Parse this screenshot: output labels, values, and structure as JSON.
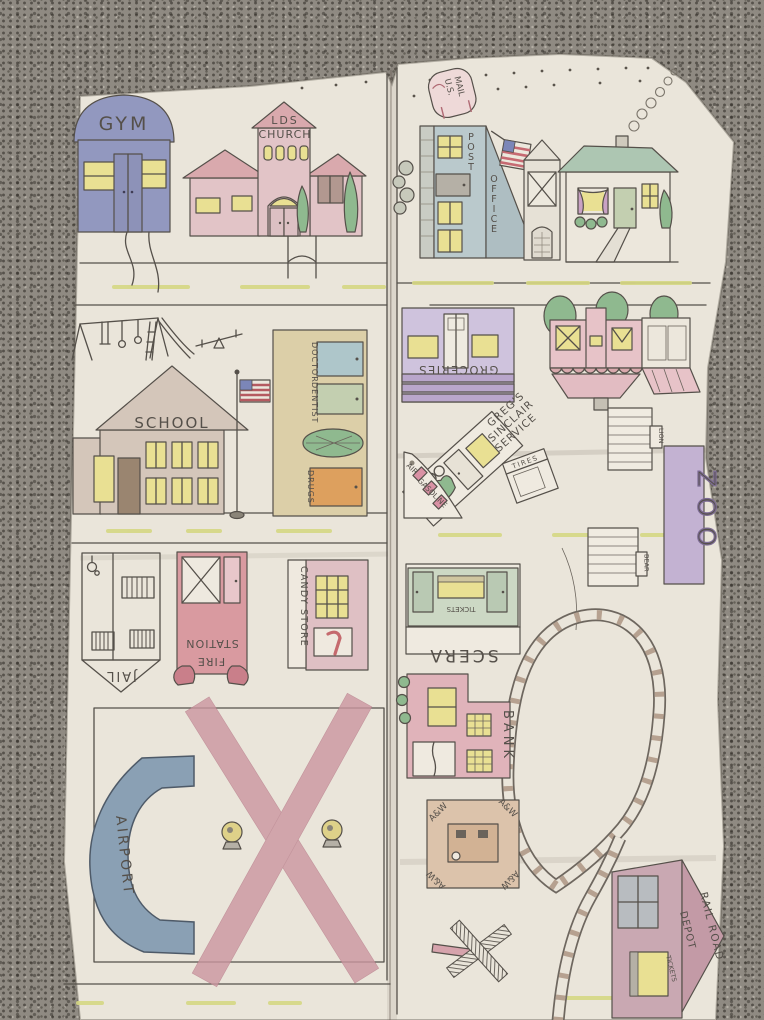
{
  "scene": {
    "description": "Hand-drawn children's town play map, colored pencil on cream fabric, photographed lying on grey carpet",
    "material": "fabric",
    "panels": 2
  },
  "palette": {
    "carpet": "#8f8a82",
    "fabric": "#eae5da",
    "ink": "#55504a",
    "road_dash": "#d5d783",
    "window_yellow": "#e9e093",
    "gym_blue": "#9298bf",
    "church_pink": "#e2c4c7",
    "roof_rose": "#d9a9ad",
    "post_office_blue": "#bac9cc",
    "house_roof_green": "#adc6b2",
    "school_tan": "#d4c6ba",
    "mall_tan": "#dccfa8",
    "door_blue": "#aec6ca",
    "door_sage": "#c3cfb0",
    "door_orange": "#dda05e",
    "tree_green": "#8fb98f",
    "groceries_purple": "#cfc3dd",
    "pink_house": "#e7c3c8",
    "zoo_purple": "#c3b2d2",
    "fire_red": "#d99aa0",
    "candy_pink": "#dfc0c4",
    "scera_green": "#ccd8c4",
    "bank_pink": "#e0b3ba",
    "aw_tan": "#dcc3ab",
    "airport_blue": "#8aa0b4",
    "runway_rose": "#cb96a0",
    "depot_mauve": "#c9a8b2",
    "rail_grey": "#6e675f",
    "tie_tan": "#ad9582"
  },
  "town": {
    "gym": {
      "label": "GYM"
    },
    "church": {
      "line1": "LDS",
      "line2": "CHURCH"
    },
    "mailbox": {
      "line1": "U.S.",
      "line2": "MAIL"
    },
    "post_office": {
      "line1": "POST",
      "line2": "OFFICE"
    },
    "school": {
      "label": "SCHOOL"
    },
    "clinic": {
      "doctor": "DOCTOR",
      "dentist": "DENTIST",
      "drugs": "DRUGS"
    },
    "groceries": {
      "label": "GROCERIES"
    },
    "gas_station": {
      "line1": "GREG'S",
      "line2": "SINCLAIR",
      "line3": "SERVICE"
    },
    "gas_island": {
      "line1": "AIR",
      "line2": "GASOLINE"
    },
    "tire_shop": {
      "label": "TIRES"
    },
    "zoo": {
      "label": "ZOO",
      "lion_cage": "LION",
      "bear_cage": "BEAR"
    },
    "jail": {
      "label": "JAIL"
    },
    "fire_station": {
      "line1": "FIRE",
      "line2": "STATION"
    },
    "candy_store": {
      "label": "CANDY STORE"
    },
    "theater": {
      "label": "SCERA",
      "booth": "TICKETS"
    },
    "bank": {
      "label": "BANK"
    },
    "root_beer_stand": {
      "corner": "A&W"
    },
    "airport": {
      "label": "AIRPORT"
    },
    "depot": {
      "line1": "RAIL ROAD",
      "line2": "DEPOT",
      "line3": "TICKETS"
    }
  }
}
